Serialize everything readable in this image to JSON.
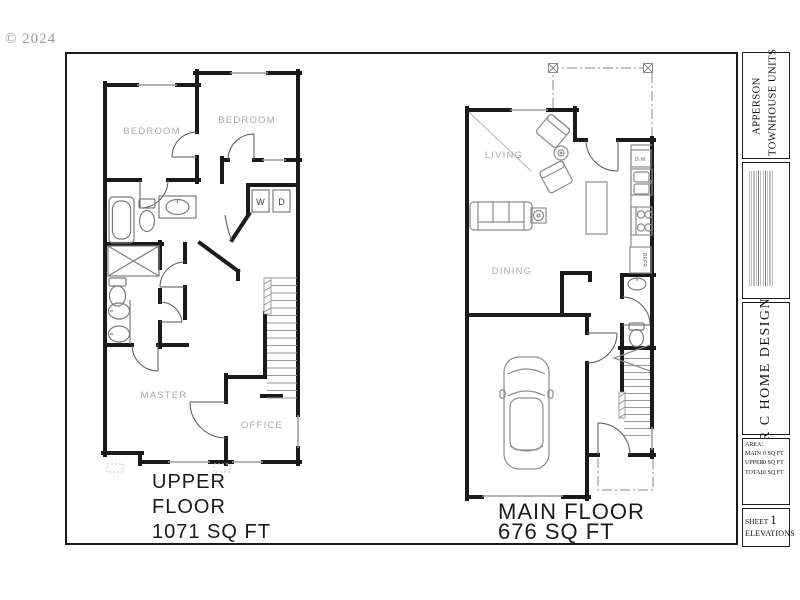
{
  "watermark": "© 2024",
  "title_block": {
    "project_line1": "APPERSON",
    "project_line2": "TOWNHOUSE UNITS",
    "company": "R C HOME DESIGN",
    "area_heading": "AREA:",
    "area_rows": [
      {
        "label": "MAIN",
        "value": "0 SQ FT"
      },
      {
        "label": "UPPER",
        "value": "0 SQ FT"
      },
      {
        "label": "TOTAL",
        "value": "0 SQ FT"
      }
    ],
    "sheet_label": "SHEET",
    "sheet_number": "1",
    "sheet_name": "ELEVATIONS"
  },
  "upper_floor": {
    "caption_line1": "UPPER",
    "caption_line2": "FLOOR",
    "caption_line3": "1071 SQ FT",
    "labels": {
      "bedroom_left": "BEDROOM",
      "bedroom_right": "BEDROOM",
      "master": "MASTER",
      "office": "OFFICE",
      "washer": "W",
      "dryer": "D"
    }
  },
  "main_floor": {
    "caption_line1": "MAIN FLOOR",
    "caption_line2": "676 SQ FT",
    "labels": {
      "living": "LIVING",
      "dining": "DINING",
      "dishwasher": "D.W.",
      "refrigerator": "REFR"
    }
  },
  "colors": {
    "wall": "#1a1a1a",
    "furniture": "#8c8c8c",
    "window": "#9a9a9a",
    "room_label": "#a8a8a8",
    "caption": "#1a1a1a",
    "watermark": "#9a9a9a"
  }
}
